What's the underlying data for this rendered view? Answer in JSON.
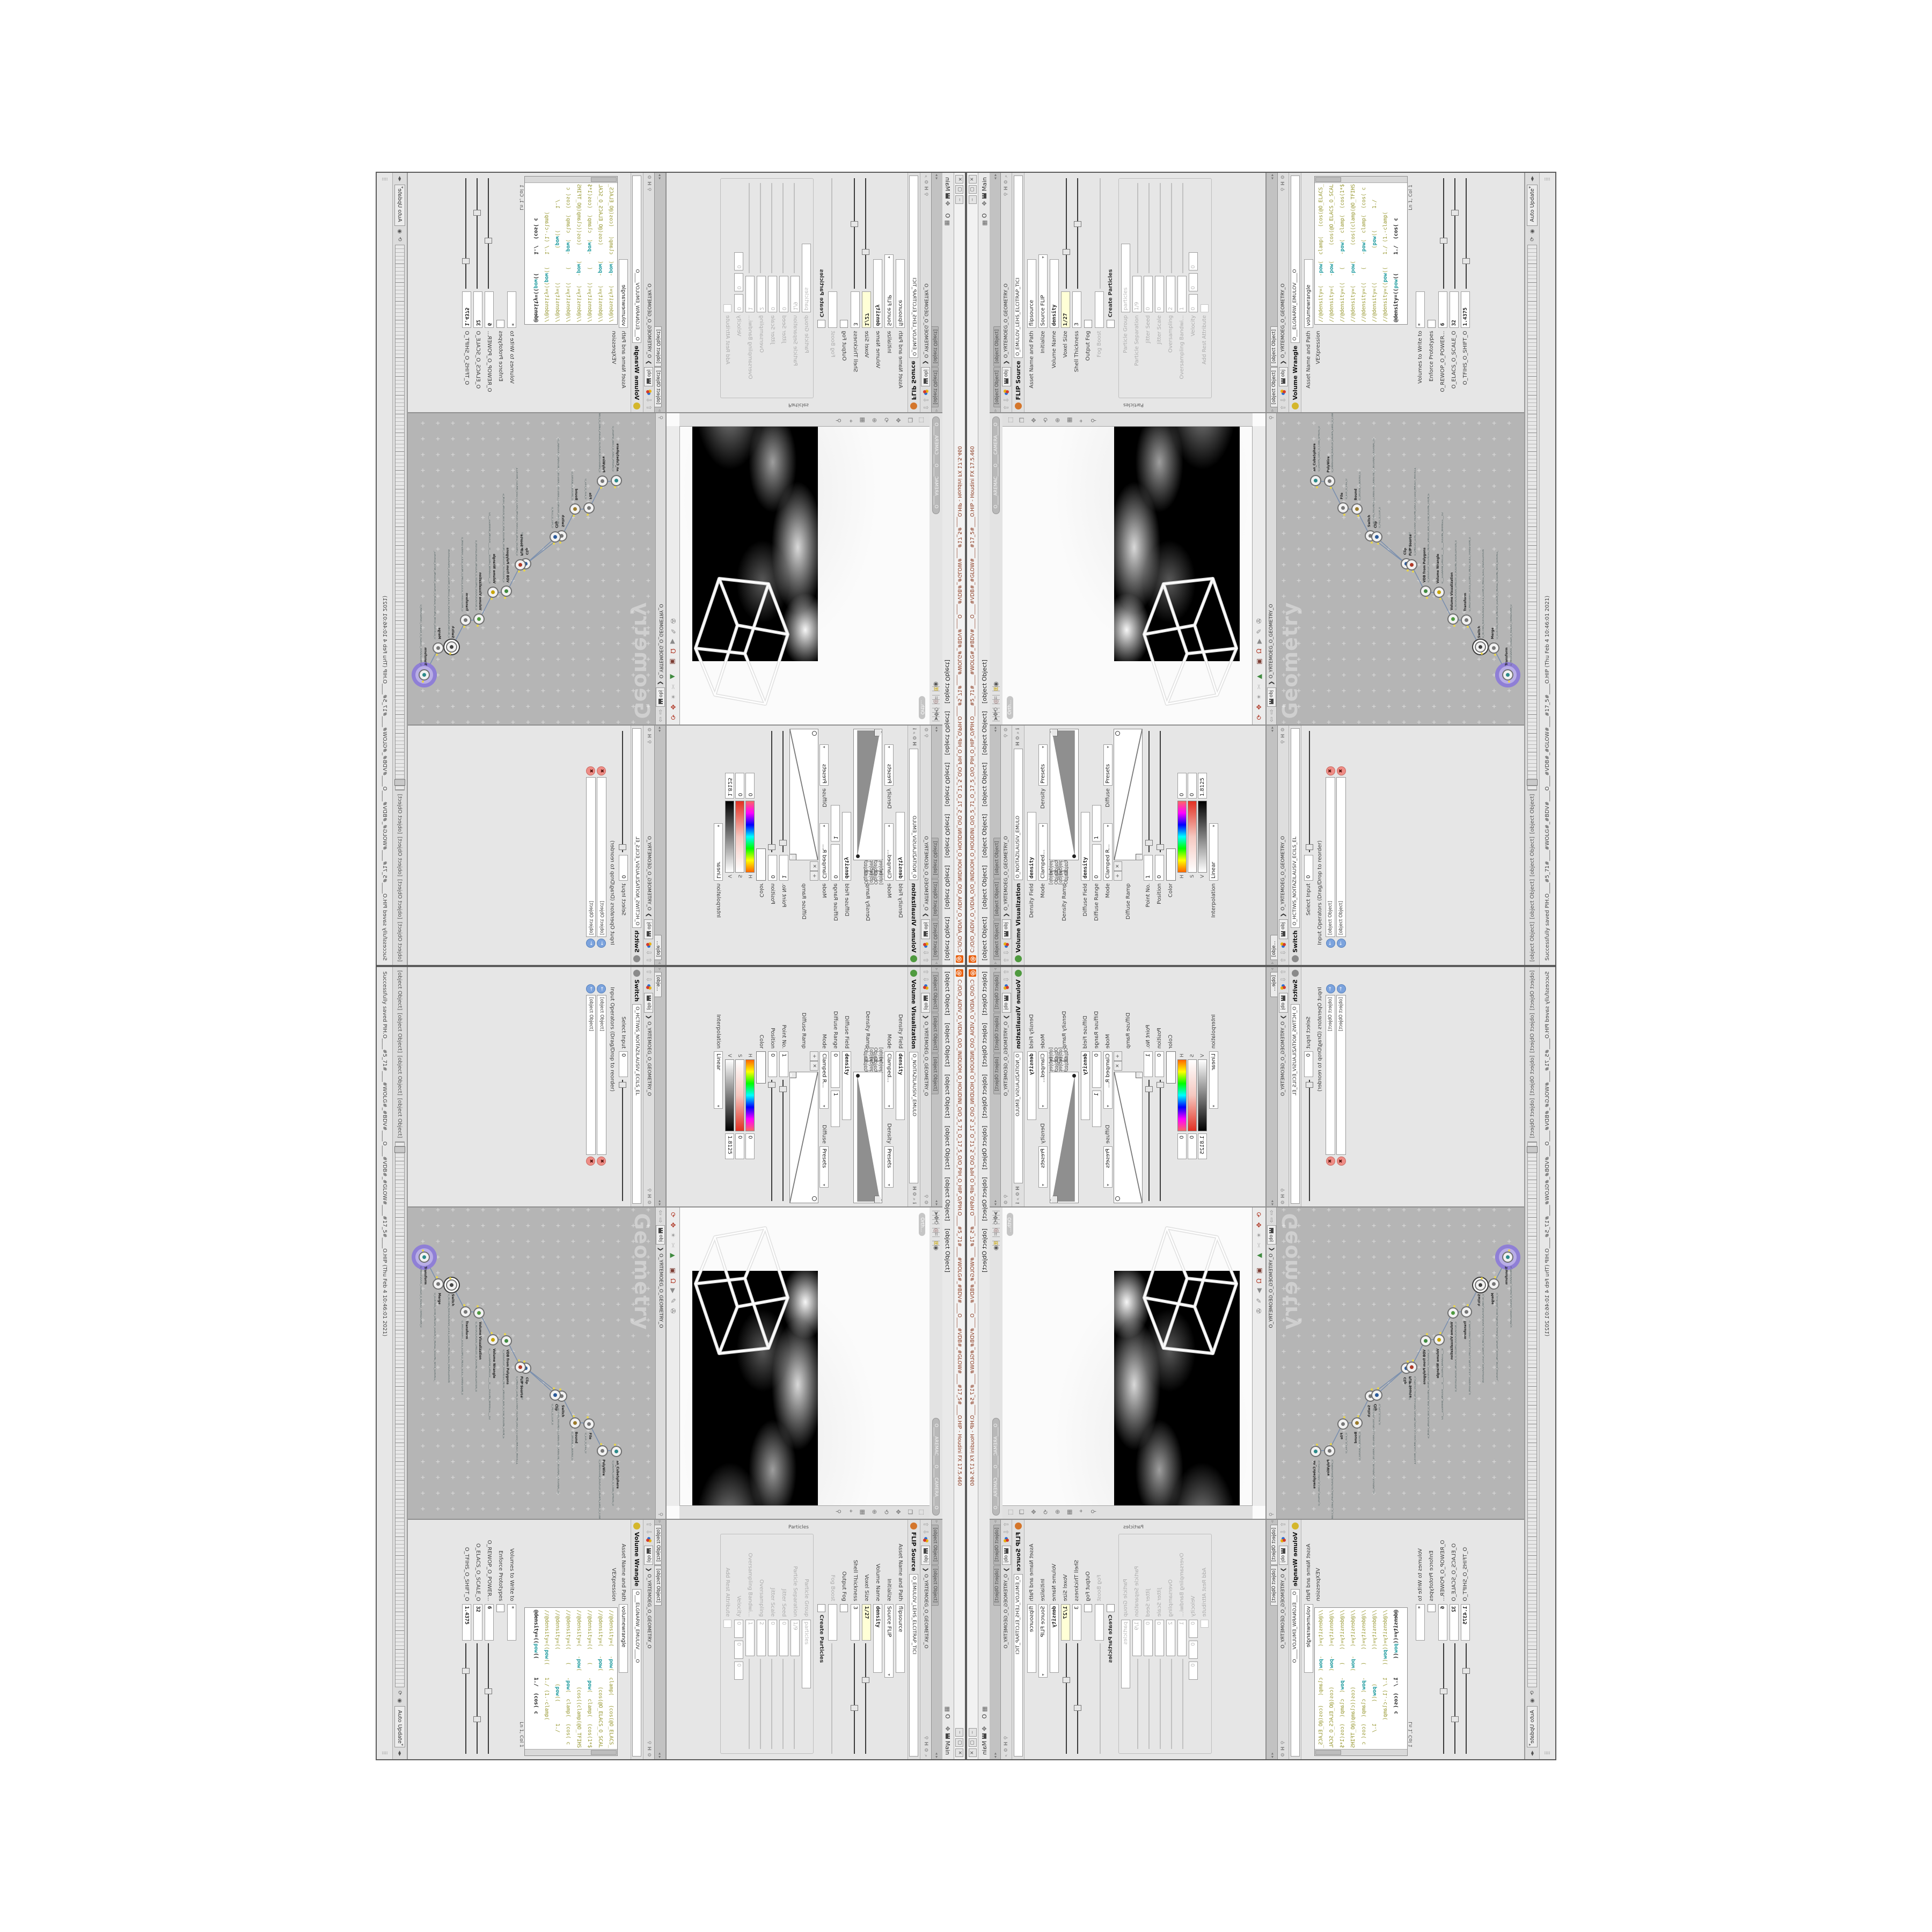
{
  "window": {
    "title": "C:/O/O_AIDIV_O_VIDIA_O/O_INIDUOH_O_HOUDINI_O/O_5_71_O_17_5_O/O_PIH_O_HIP_O/PIH.O____#5_71#____#WOLG#_#BDV#____O____#VDB#_#GLOW#____#17_5#____O.HIP - Houdini FX 17.5.460",
    "logo_glyph": "@",
    "buttons": {
      "minimize": "‒",
      "maximize": "▢",
      "close": "✕"
    },
    "menu": [
      "File",
      "Edit",
      "Render",
      "Assets",
      "Windows",
      "Help"
    ],
    "layout_label": "O",
    "desktop_label": "Main"
  },
  "breadcrumb": {
    "root": "obj",
    "sep": "❯",
    "path": "O_YRTEMOEG_O_GEOMETRY_O"
  },
  "panes": {
    "visualization": {
      "tabs": [
        "O___ARTNAM_...",
        "O___AREMAC_...",
        "O_NOITAZILAUSIV..."
      ],
      "title": "Volume Visualization",
      "node_name": "O_NOITAZILAUSIV_EMULO",
      "icon_color": "#4f9a3f",
      "rows": {
        "density_field": {
          "label": "Density Field",
          "value": "density"
        },
        "mode1": {
          "label": "Mode",
          "value": "Clamped..."
        },
        "density_sub": {
          "label": "Density",
          "value": "Presets"
        },
        "density_ramp": {
          "label": "Density Ramp"
        },
        "diffuse_field": {
          "label": "Diffuse Field",
          "value": "density"
        },
        "diffuse_range": {
          "label": "Diffuse Range",
          "v1": "0",
          "v2": "1"
        },
        "mode2": {
          "label": "Mode",
          "value": "Clamped R..."
        },
        "diffuse_sub": {
          "label": "Diffuse",
          "value": "Presets"
        },
        "diffuse_ramp": {
          "label": "Diffuse Ramp"
        },
        "point_no": {
          "label": "Point No.",
          "value": "1"
        },
        "position": {
          "label": "Position",
          "value": "0"
        },
        "color": {
          "label": "Color"
        },
        "hsv": [
          {
            "ch": "H",
            "value": "0",
            "cls": "h"
          },
          {
            "ch": "S",
            "value": "0",
            "cls": "s"
          },
          {
            "ch": "V",
            "value": "1.8125",
            "cls": "v"
          }
        ],
        "interpolation": {
          "label": "Interpolation",
          "value": "Linear"
        }
      },
      "ramp_buttons": [
        "+",
        "✕",
        "⊞",
        "△"
      ]
    },
    "switch": {
      "tabs": [
        "O_HCTIWS_NOITAZILAUSIV_ECILS_ELDIM_O_MIDLE_SLICE_VISUAL..."
      ],
      "title": "Switch",
      "node_name": "O_HCTIWS_NOITAZILAUSIV_ECILS_EL",
      "icon_color": "#8a8a8a",
      "rows": {
        "select_input": {
          "label": "Select Input",
          "value": "0"
        },
        "input_ops": {
          "label": "Input Operators (Drag/Drop to reorder)"
        }
      },
      "inputs": [
        "O_NOITAZILAUSIV_EMULOV_O_VOLUME_VISUALIZATION_O",
        "O_MROFSNART_ECILS_ELDIM_O_MIDLE_SLICE_TRANSFORM_O"
      ]
    },
    "flip": {
      "tabs": [
        "O_EMULOV_LEHS_ELCITRAP_TICILPMI_DIVLF_O_FLUID_IMPLICIT_PARTI...",
        "C:/O/O_ERAWTF..."
      ],
      "title": "FLIP Source",
      "node_name": "O_EMULOV_LEHS_ELCITRAP_TICI",
      "icon_color": "#d4762b",
      "rows": {
        "asset": {
          "label": "Asset Name and Path",
          "value": "flipsource"
        },
        "initialize": {
          "label": "Initialize",
          "value": "Source FLIP"
        },
        "volume_name": {
          "label": "Volume Name",
          "value": "density"
        },
        "voxel_size": {
          "label": "Voxel Size",
          "value": "1/27"
        },
        "shell_thickness": {
          "label": "Shell Thickness",
          "value": "3"
        },
        "output_fog": {
          "label": "Output Fog"
        },
        "fog_boost": {
          "label": "Fog Boost",
          "value": ""
        },
        "create_particles": {
          "label": "Create Particles"
        },
        "section": "Particles",
        "particle_group": {
          "label": "Particle Group",
          "value": "particles"
        },
        "particle_separation": {
          "label": "Particle Separation",
          "value": "1/9"
        },
        "jitter_seed": {
          "label": "Jitter Seed",
          "value": "0"
        },
        "jitter_scale": {
          "label": "Jitter Scale",
          "value": "0"
        },
        "oversampling": {
          "label": "Oversampling",
          "value": "2"
        },
        "oversampling_bw": {
          "label": "Oversampling Bandwi...",
          "value": "1"
        },
        "velocity": {
          "label": "Velocity",
          "v1": "0",
          "v2": "0",
          "v3": "0"
        },
        "add_rest": {
          "label": "Add Rest Attribute"
        }
      }
    },
    "wrangle": {
      "tabs": [
        "O___ELGNARW_EMULOV___O___VOLUME_WRANGL...",
        "C:/O/O_ERAWTF..."
      ],
      "title": "Volume Wrangle",
      "node_name": "O___ELGNARW_EMULOV____O",
      "icon_color": "#d4b62b",
      "rows": {
        "asset": {
          "label": "Asset Name and Path",
          "value": "volumewrangle"
        },
        "vexpression": {
          "label": "VEXpression"
        },
        "cursor_pos": "Ln 1, Col 1",
        "volumes": {
          "label": "Volumes to Write to",
          "value": "*"
        },
        "enforce": {
          "label": "Enforce Prototypes"
        },
        "power": {
          "label": "O_REWOP_O_POWER...",
          "value": "6"
        },
        "scale": {
          "label": "O_ELACS_O_SCALE_O",
          "value": "32"
        },
        "shift": {
          "label": "O_TFIHS_O_SHIFT_O",
          "value": "1.4375"
        }
      },
      "code_lines": [
        {
          "text": "//@density=(   -pow(  clamp(   (cos(@O_ELACS_",
          "active": false
        },
        {
          "text": "//@density=(   -pow(     (cos(@O_ELACS_O_SCAL",
          "active": false
        },
        {
          "text": "//@density=((    (    -pow(  clamp(  (cos(1*$",
          "active": false
        },
        {
          "text": "//@density=(   -pow(     (cos((clamp(@O_TFIHS",
          "active": false
        },
        {
          "text": "//@density=((    (    -pow(  clamp(  (cos( c",
          "active": false
        },
        {
          "text": "//@density=((           (pow((       1./",
          "active": false
        },
        {
          "text": "//@density=((pow((    1./ (1.-clamp(",
          "active": false
        },
        {
          "text": "@density=((pow((      1./  (cos( c",
          "active": true
        }
      ]
    },
    "viewport": {
      "camera_pill": "O____AREMAC____O____CAMERA____O",
      "view_label": "Orth...",
      "toolbar_top": [
        {
          "name": "select-arrow-icon",
          "glyph": "➤",
          "color": "#666666"
        },
        {
          "name": "move-handle-icon",
          "glyph": "✥",
          "color": "#666666"
        },
        {
          "name": "tumble-icon",
          "glyph": "⟲",
          "color": "#666666"
        },
        {
          "name": "divider",
          "glyph": "",
          "color": ""
        },
        {
          "name": "snap-magnet-icon",
          "glyph": "◎",
          "color": "#8a5a5a"
        },
        {
          "name": "grid-snap-icon",
          "glyph": "⌗",
          "color": "#777777"
        },
        {
          "name": "divider",
          "glyph": "",
          "color": ""
        },
        {
          "name": "quad-view-icon",
          "glyph": "⊞",
          "color": "#c8a400"
        },
        {
          "name": "camera-view-icon",
          "glyph": "◉",
          "color": "#555555"
        }
      ],
      "toolbar_right": [
        {
          "name": "layout-single-icon",
          "glyph": "⬚",
          "color": "#777777"
        },
        {
          "name": "layout-stack-icon",
          "glyph": "❐",
          "color": "#777777"
        },
        {
          "name": "pan-icon",
          "glyph": "✥",
          "color": "#777777"
        },
        {
          "name": "orbit-icon",
          "glyph": "⟲",
          "color": "#777777"
        },
        {
          "name": "zoom-icon",
          "glyph": "⊕",
          "color": "#777777"
        },
        {
          "name": "grid-icon",
          "glyph": "▦",
          "color": "#777777"
        },
        {
          "name": "target-icon",
          "glyph": "⌖",
          "color": "#777777"
        },
        {
          "name": "pin-icon",
          "glyph": "⚲",
          "color": "#777777"
        }
      ],
      "toolbar_bottom": [
        {
          "name": "recycle-icon",
          "glyph": "⟳",
          "color": "#b03a28"
        },
        {
          "name": "gizmo-icon",
          "glyph": "✥",
          "color": "#b03a28"
        },
        {
          "name": "connector-icon",
          "glyph": "✴",
          "color": "#9a9a9a"
        },
        {
          "name": "scissors-icon",
          "glyph": "✂",
          "color": "#bdbdbd"
        },
        {
          "name": "rgb-triangle-icon",
          "glyph": "▲",
          "color": "#3f8a3f"
        },
        {
          "name": "divider",
          "glyph": "",
          "color": ""
        },
        {
          "name": "magnet-frame-icon",
          "glyph": "▣",
          "color": "#7a3a30"
        },
        {
          "name": "magnet-icon",
          "glyph": "Ω",
          "color": "#b03a28"
        },
        {
          "name": "play-small-icon",
          "glyph": "▶",
          "color": "#8a8a8a"
        },
        {
          "name": "brush-icon",
          "glyph": "✎",
          "color": "#8a8a8a"
        },
        {
          "name": "reel-icon",
          "glyph": "✇",
          "color": "#777777"
        }
      ]
    },
    "network": {
      "tab": "O_YRTEMOEG_O_GEOMETRY_O",
      "watermark": "Geometry",
      "nodes": [
        {
          "type": "an_CubeSphere",
          "name": "O_EREHPS_EBUC_O_CUBE_SPHERE_O",
          "color": "#2b8a8a"
        },
        {
          "type": "PolyWire",
          "name": "O_EMANFERIW_NOGYLOP_EREHPS_EBUC_O_CUBE_SPHERE_POLYGON_WIREFRAME_O",
          "color": "#777777"
        },
        {
          "type": "File",
          "name": "O_ELIF_O_FILE_O",
          "color": "#777777"
        },
        {
          "type": "Bound",
          "name": "O_DNUOB_O_BOUND_O",
          "color": "#9a7a2b"
        },
        {
          "type": "Switch",
          "name": "O_HCTIWS_YRTEMOEG_LANRETXE_LANRETNI_O_INTERNAL_EXTERNAL_GEOMETRY_SWITCH_O",
          "color": "#777777"
        },
        {
          "type": "Clip",
          "name": "O_PILC_O_CLIP_O",
          "color": "#2b5a9a"
        },
        {
          "type": "Clip",
          "name": "O_PILC_O_CLIP_O2",
          "color": "#2b5a9a"
        },
        {
          "type": "FLIP Source",
          "name": "O_EMULOV_LEHS_ELCITRAP_TICILPMI_DIVLF_O_FLUID_IMPLICIT_PARTICLE_SHEL_VOLUME_O",
          "color": "#b03a28"
        },
        {
          "type": "VDB from Polygons",
          "name": "O_SNOGYLOP_YRTEMOEG_MORF_EMULOV_BDV_O_VDB_VOLUME_FROM_GEOMETRY_POLYGONS_O",
          "color": "#3f8a3f"
        },
        {
          "type": "Volume Wrangle",
          "name": "O___ELGNARW_EMULOV____O____VOLUME_WRANGLE___O2",
          "color": "#c8a400"
        },
        {
          "type": "Volume Visualization",
          "name": "O_NOITAZILAUSIV_EMULOV_O_VOLUME_VISUALIZATION_O",
          "color": "#4f9a3f"
        },
        {
          "type": "Transform",
          "name": "O_MROFSNART_ECILS_ELDIM_O_MIDLE_SLICE_TRANSFORM_O",
          "color": "#777777"
        },
        {
          "type": "Switch",
          "name": "O_HCTIWS_NOITAZILAUSIV_ECILS_ELDIM_O_MIDLE_SLICE_VISUALIZATION_SWITCH_O",
          "color": "#444444",
          "selected": true
        },
        {
          "type": "Merge",
          "name": "O_ECAFRUS_HTIW_EMULOV_EGREM_O_MERGE_VOLUME_WITH_SURFACE_O",
          "color": "#777777"
        },
        {
          "type": "Transform",
          "name": "O_MROFSNART_TLUSER_O_RESULT_TRANSFORM_O",
          "color": "#2b8a8a",
          "display": true
        }
      ]
    }
  },
  "playbar": {
    "transport": [
      "⏮",
      "◀",
      "▶",
      "⏭"
    ],
    "auto_update": "Auto Update",
    "refresh_icon": "⟳",
    "sphere_icon": "◉"
  },
  "statusbar": {
    "message": "Successfully saved PIH.O____#5_71#____#WOLG#_#BDV#____O____#VDB#_#GLOW#____#17_5#____O.HIP (Thu Feb 4 10:46:01 2021)"
  },
  "colors": {
    "code_comment": "#96962e",
    "code_keyword": "#14969a",
    "expression_field": "#ffffd6",
    "display_node_halo": "#8f7fd6",
    "network_bg": "#b5b5b5",
    "houdini_orange": "#e8600f"
  }
}
